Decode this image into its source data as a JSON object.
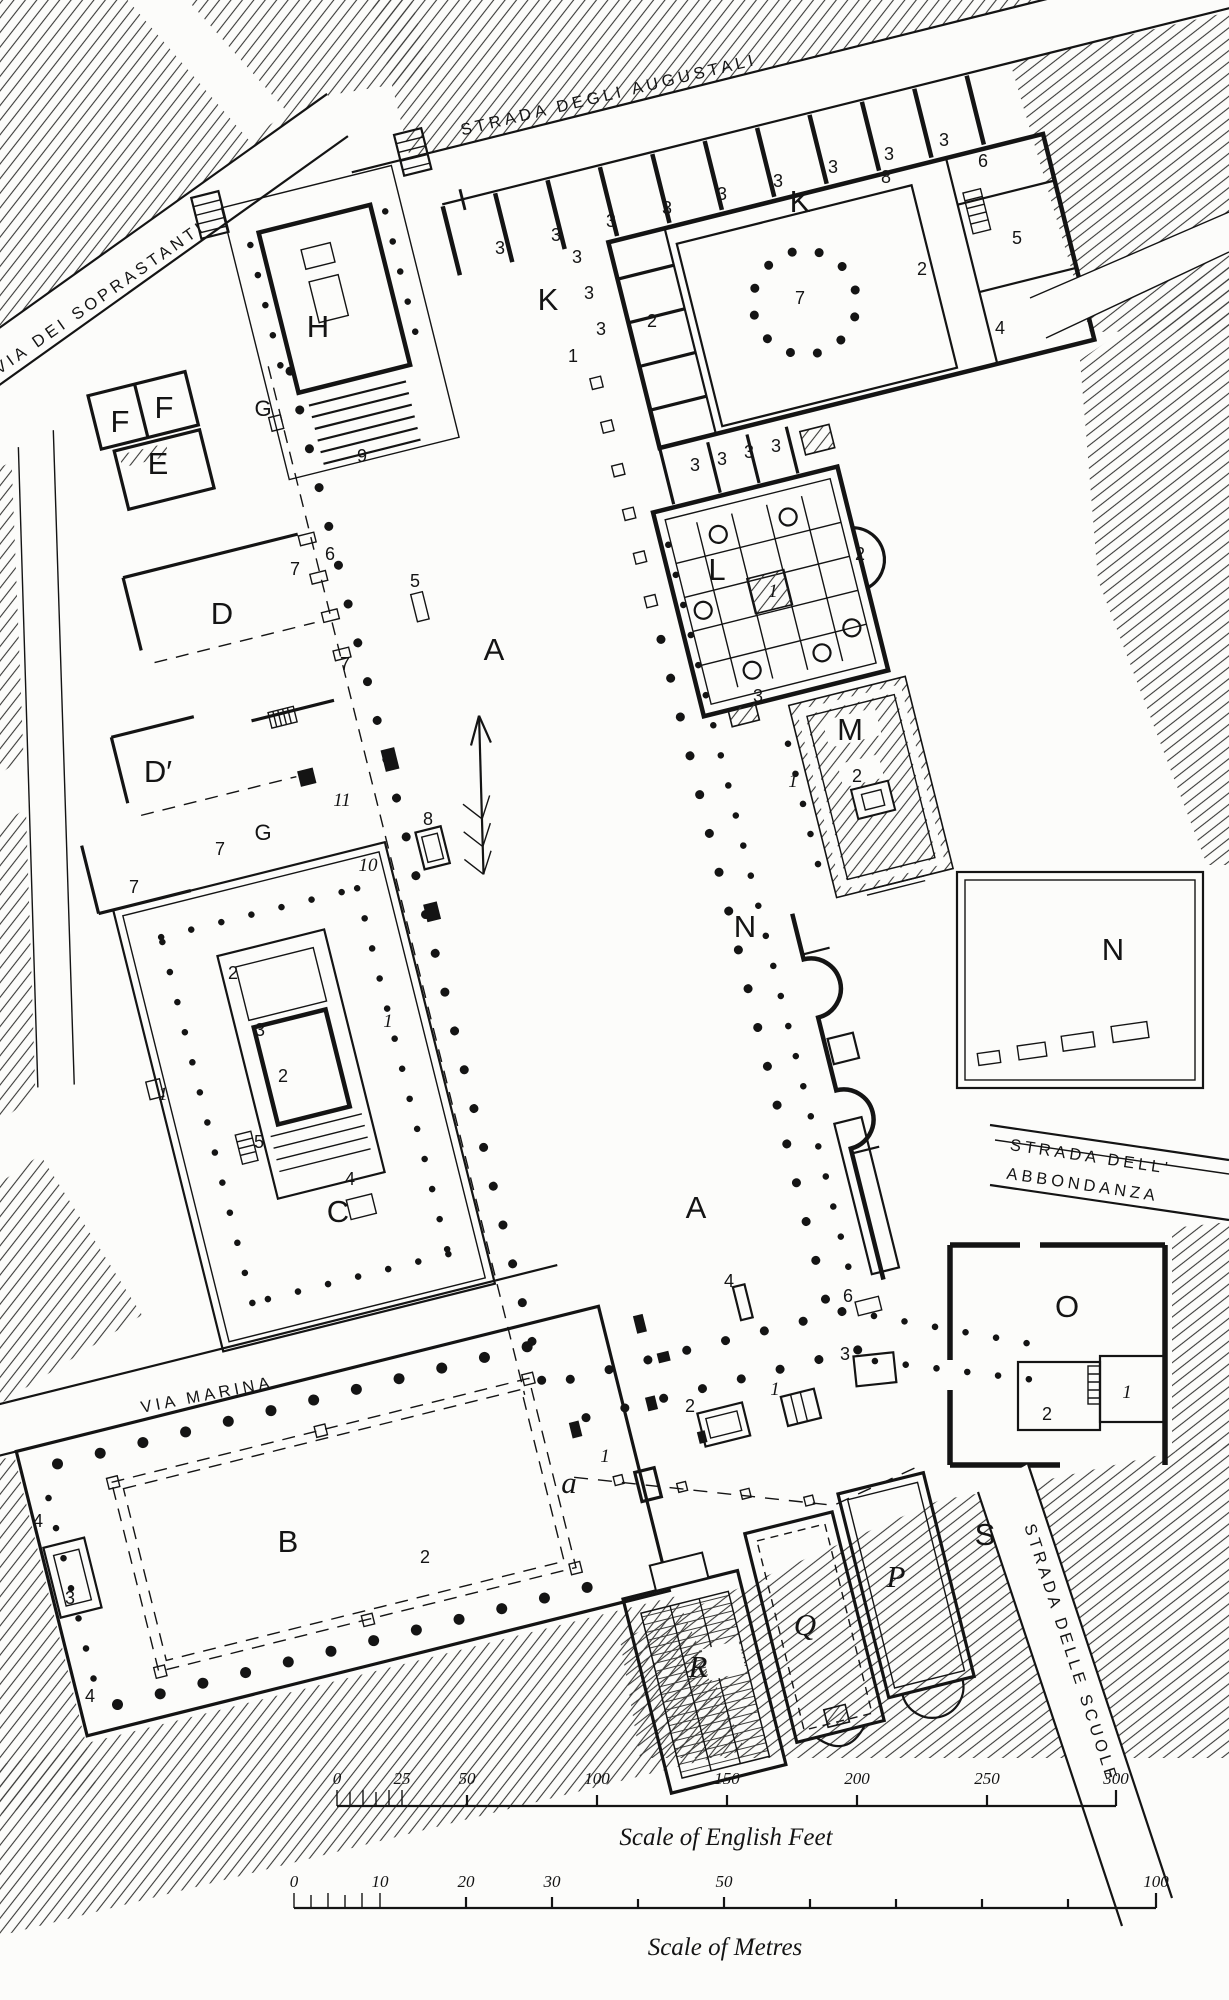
{
  "plan": {
    "streets": {
      "augustali": "STRADA DEGLI AUGUSTALI",
      "soprastanti": "VIA DEI SOPRASTANTI",
      "marina": "VIA MARINA",
      "abbondanza_line1": "STRADA DELL'",
      "abbondanza_line2": "ABBONDANZA",
      "scuole": "STRADA DELLE SCUOLE"
    },
    "buildings": {
      "A": "A",
      "B": "B",
      "C": "C",
      "D": "D",
      "D_prime": "D′",
      "E": "E",
      "F": "F",
      "G": "G",
      "H": "H",
      "I": "I",
      "K": "K",
      "L": "L",
      "M": "M",
      "N": "N",
      "O": "O",
      "P": "P",
      "Q": "Q",
      "R": "R",
      "S": "S",
      "a": "a"
    },
    "numbers": {
      "n1": "1",
      "n2": "2",
      "n3": "3",
      "n4": "4",
      "n5": "5",
      "n6": "6",
      "n7": "7",
      "n8": "8",
      "n9": "9",
      "n10": "10",
      "n11": "11"
    },
    "scale_feet": {
      "title": "Scale of English Feet",
      "ticks": [
        "0",
        "25",
        "50",
        "100",
        "150",
        "200",
        "250",
        "300"
      ]
    },
    "scale_metres": {
      "title": "Scale of Metres",
      "ticks": [
        "0",
        "10",
        "20",
        "30",
        "50",
        "100"
      ]
    }
  }
}
